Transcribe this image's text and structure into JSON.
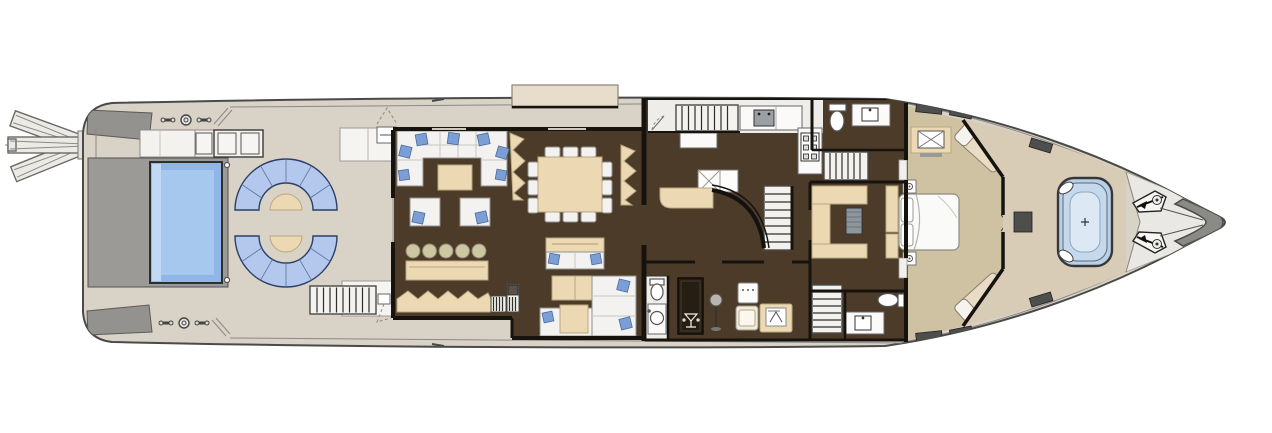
{
  "drawing": {
    "kind": "yacht-main-deck-floor-plan",
    "visible_text": "none",
    "orientation": "bow-right-stern-left"
  },
  "colors": {
    "background": "#ffffff",
    "hull_deck": "#d9d2c6",
    "hull_outline": "#4a4a48",
    "platform_gray": "#93928f",
    "pool_surround": "#9b9a97",
    "pool_water": "#8fb6e6",
    "pool_water_mid": "#a6c8ef",
    "pool_water_light": "#c2d9f5",
    "sofa_blue": "#b3c8ec",
    "pillow_blue": "#7b9fd4",
    "upholstery_white": "#f3f2f0",
    "floor_wood": "#4d3b29",
    "floor_galley": "#efede9",
    "carpet_tan": "#cfc2a2",
    "furniture_tan": "#ecd9b4",
    "furniture_tan_edge": "#b9a77f",
    "stool_khaki": "#cdc6a2",
    "wall_black": "#16130f",
    "foredeck_white": "#eae8e4",
    "bow_nose_gray": "#8a8a87",
    "hatch_dark": "#4e4e4c",
    "jacuzzi_rim": "#b9cfe4",
    "jacuzzi_mid": "#c6d9ec",
    "jacuzzi_water": "#dce9f4",
    "cabinet_dark": "#261d13",
    "metal_gray": "#9aa0a4"
  },
  "depicted_counts": {
    "passerelle_positions": 3,
    "aft_pool": 1,
    "aft_curved_sofas": 2,
    "aft_round_tables": 2,
    "salon_armchairs": 2,
    "bar_stools": 5,
    "dining_side_chairs_per_side": 3,
    "media_coffee_tables": 2,
    "staircases": 5,
    "toilets": 3,
    "sinks": 3,
    "master_bed": 1,
    "master_chaise_lounges": 2,
    "bow_jacuzzi": 1,
    "anchor_windlasses": 2
  }
}
